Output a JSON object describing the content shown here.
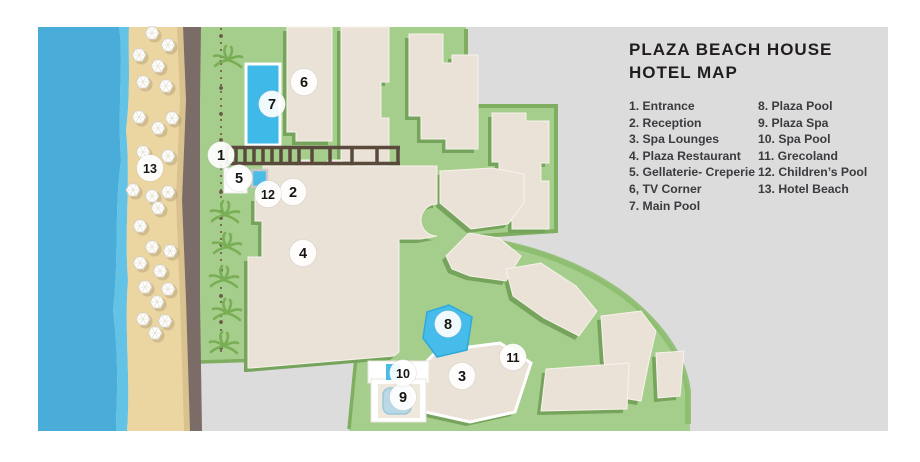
{
  "legend": {
    "title_line1": "PLAZA BEACH HOUSE",
    "title_line2": "HOTEL MAP",
    "items_col1": [
      "1. Entrance",
      "2. Reception",
      "3. Spa Lounges",
      "4. Plaza Restaurant",
      "5. Gellaterie- Creperie",
      "6, TV Corner",
      "7. Main Pool"
    ],
    "items_col2": [
      "8. Plaza Pool",
      "9. Plaza Spa",
      "10. Spa Pool",
      "11. Grecoland",
      "12. Children’s Pool",
      "13. Hotel Beach"
    ]
  },
  "map": {
    "markers": [
      "1",
      "2",
      "3",
      "4",
      "5",
      "6",
      "7",
      "8",
      "9",
      "10",
      "11",
      "12",
      "13"
    ]
  },
  "colors": {
    "background_gray": "#dcdcdc",
    "water_blue": "#4aacd8",
    "shore_blue": "#63c3e6",
    "sand": "#ebd5a0",
    "road_brown": "#7c6c67",
    "grass_green": "#a5cd8b",
    "grass_shadow_green": "#76a45c",
    "building_beige": "#eae2d6",
    "pool_blue": "#41b7e6",
    "marker_white": "#ffffff"
  }
}
